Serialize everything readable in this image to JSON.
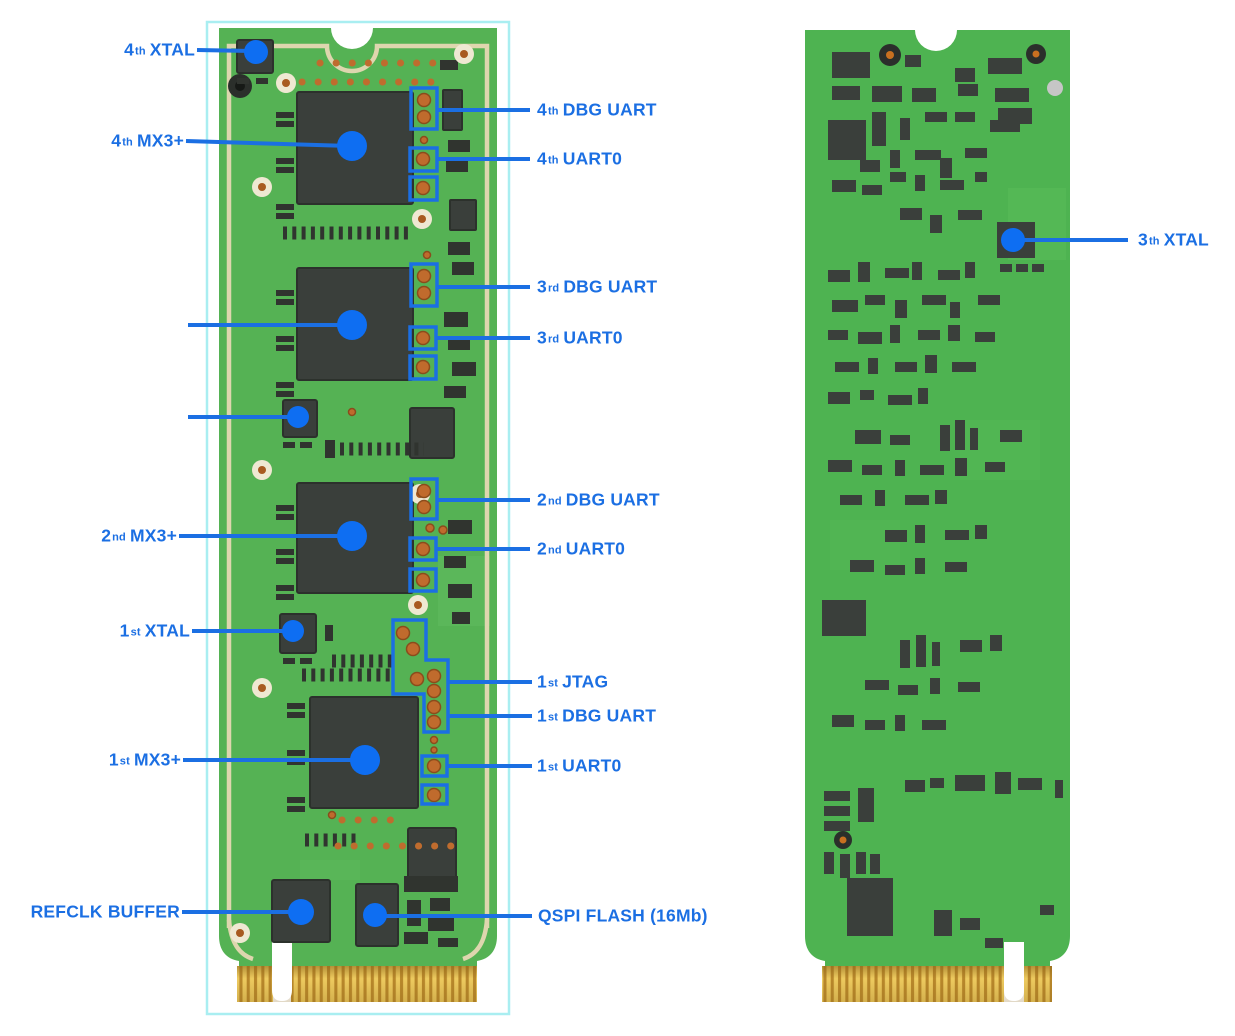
{
  "colors": {
    "accent_blue": "#1b6fe3",
    "marker_blue": "#0e6ef2",
    "board_green_front": "#55b254",
    "board_green_back": "#4eb351",
    "silkscreen_cream": "#ded6ae",
    "chip_dark": "#3a3f3b",
    "pin_orange": "#c06b2d",
    "gold_finger": "#d9ad3e",
    "highlight_cyan": "#a9eef1"
  },
  "annotations": {
    "front_left": [
      {
        "num": "4",
        "sup": "th",
        "label": "XTAL"
      },
      {
        "num": "4",
        "sup": "th",
        "label": "MX3+"
      },
      {
        "num": "2",
        "sup": "nd",
        "label": "MX3+"
      },
      {
        "num": "1",
        "sup": "st",
        "label": "XTAL"
      },
      {
        "num": "1",
        "sup": "st",
        "label": "MX3+"
      },
      {
        "num": "",
        "sup": "",
        "label": "REFCLK BUFFER"
      }
    ],
    "front_right": [
      {
        "num": "4",
        "sup": "th",
        "label": "DBG UART"
      },
      {
        "num": "4",
        "sup": "th",
        "label": "UART0"
      },
      {
        "num": "3",
        "sup": "rd",
        "label": "DBG UART"
      },
      {
        "num": "3",
        "sup": "rd",
        "label": "UART0"
      },
      {
        "num": "2",
        "sup": "nd",
        "label": "DBG UART"
      },
      {
        "num": "2",
        "sup": "nd",
        "label": "UART0"
      },
      {
        "num": "1",
        "sup": "st",
        "label": "JTAG"
      },
      {
        "num": "1",
        "sup": "st",
        "label": "DBG UART"
      },
      {
        "num": "1",
        "sup": "st",
        "label": "UART0"
      },
      {
        "num": "",
        "sup": "",
        "label": "QSPI FLASH (16Mb)"
      }
    ],
    "back": [
      {
        "num": "3",
        "sup": "th",
        "label": "XTAL"
      }
    ]
  }
}
